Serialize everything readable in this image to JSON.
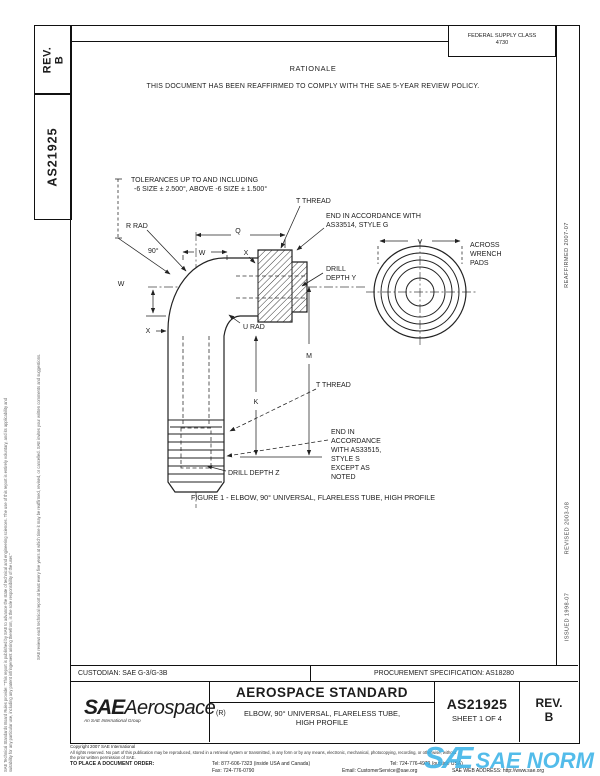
{
  "page": {
    "left_margin": {
      "disclaimer_line1": "SAE Technical Standards Board Rules provide: \"This report is published by SAE to advance the state of technical and engineering sciences. The use of this report is entirely voluntary, and its applicability and suitability for any particular use, including any patent infringement arising therefrom, is the sole responsibility of the user.\"",
      "disclaimer_line2": "SAE reviews each technical report at least every five years at which time it may be reaffirmed, revised, or cancelled. SAE invites your written comments and suggestions.",
      "rev_label": "REV.",
      "rev_value": "B",
      "doc_number": "AS21925"
    },
    "right_margin": {
      "reaffirmed": "REAFFIRMED 2007-07",
      "revised": "REVISED 2003-08",
      "issued": "ISSUED 1998-07"
    },
    "header": {
      "fsc_label": "FEDERAL SUPPLY CLASS",
      "fsc_value": "4730",
      "rationale_title": "RATIONALE",
      "rationale_text": "THIS DOCUMENT HAS BEEN REAFFIRMED TO COMPLY WITH THE SAE 5-YEAR REVIEW POLICY."
    },
    "drawing": {
      "labels": {
        "tolerances_line1": "TOLERANCES UP TO AND INCLUDING",
        "tolerances_line2": "-6 SIZE ± 2.500°, ABOVE -6 SIZE ± 1.500°",
        "t_thread_top": "T THREAD",
        "end_top_1": "END IN ACCORDANCE WITH",
        "end_top_2": "AS33514, STYLE G",
        "r_rad": "R RAD",
        "angle_90": "90°",
        "q": "Q",
        "w_top": "W",
        "x_top": "X",
        "w_left": "W",
        "x_left": "X",
        "drill_y_1": "DRILL",
        "drill_y_2": "DEPTH Y",
        "v": "V",
        "across_1": "ACROSS",
        "across_2": "WRENCH",
        "across_3": "PADS",
        "u_rad": "U RAD",
        "m": "M",
        "k": "K",
        "t_thread_right": "T THREAD",
        "end_bot_1": "END IN",
        "end_bot_2": "ACCORDANCE",
        "end_bot_3": "WITH AS33515,",
        "end_bot_4": "STYLE S",
        "end_bot_5": "EXCEPT AS",
        "end_bot_6": "NOTED",
        "drill_depth_z": "DRILL DEPTH Z"
      },
      "caption": "FIGURE 1 - ELBOW, 90° UNIVERSAL, FLARELESS TUBE, HIGH PROFILE"
    },
    "title_block": {
      "custodian": "CUSTODIAN: SAE G-3/G-3B",
      "procurement": "PROCUREMENT SPECIFICATION: AS18280",
      "logo_sae": "SAE",
      "logo_aerospace": "Aerospace",
      "logo_tagline": "An SAE International Group",
      "standard_type": "AEROSPACE STANDARD",
      "revision_mark": "(R)",
      "title_line1": "ELBOW, 90° UNIVERSAL, FLARELESS TUBE,",
      "title_line2": "HIGH PROFILE",
      "doc_number": "AS21925",
      "sheet": "SHEET 1 OF 4",
      "rev_label": "REV.",
      "rev_value": "B"
    },
    "footer": {
      "copyright": "Copyright 2007 SAE International",
      "rights_line1": "All rights reserved. No part of this publication may be reproduced, stored in a retrieval system or transmitted, in any form or by any means, electronic, mechanical, photocopying, recording, or otherwise, without",
      "rights_line2": "the prior written permission of SAE.",
      "order_label": "TO PLACE A DOCUMENT ORDER:",
      "tel_inside": "Tel: 877-606-7323 (inside USA and Canada)",
      "tel_outside": "Tel: 724-776-4970 (outside USA)",
      "fax": "Fax: 724-776-0790",
      "email": "Email: CustomerService@sae.org",
      "web": "SAE WEB ADDRESS: http://www.sae.org",
      "watermark_sae": "SÆ",
      "watermark_text": "SAE NORM"
    }
  }
}
